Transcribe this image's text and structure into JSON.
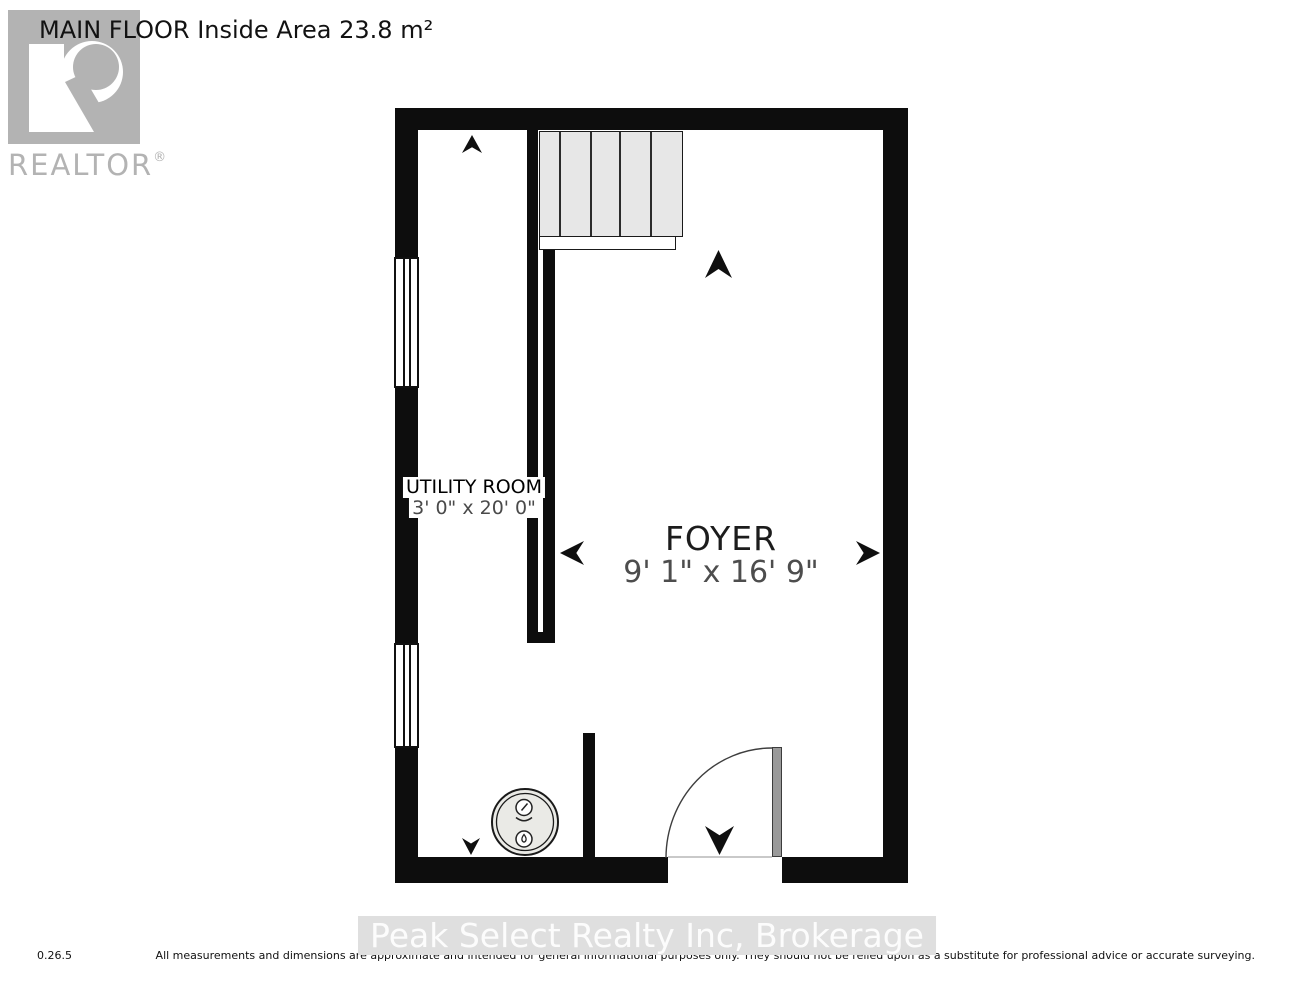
{
  "header": {
    "title": "MAIN FLOOR Inside Area 23.8 m²"
  },
  "logo": {
    "brand": "REALTOR",
    "registered": "®"
  },
  "floorplan": {
    "rooms": [
      {
        "name": "UTILITY ROOM",
        "dimensions": "3' 0\" x 20' 0\""
      },
      {
        "name": "FOYER",
        "dimensions": "9' 1\" x 16' 9\""
      }
    ],
    "symbols": [
      "stairs",
      "stair-landing",
      "entry-door-swing",
      "water-heater",
      "window",
      "north-arrow"
    ],
    "colors": {
      "wall": "#0d0d0d",
      "stairs_fill": "#e7e7e7",
      "appliance_fill": "#eaeae6",
      "door_leaf": "#9a9a9a",
      "logo_gray": "#b3b3b3",
      "dimension_text": "#4d4d4d",
      "watermark_bg": "#dfdfdf",
      "watermark_text": "#fcfcfc"
    }
  },
  "footer": {
    "version": "0.26.5",
    "watermark": "Peak Select Realty Inc, Brokerage",
    "disclaimer": "All measurements and dimensions are approximate and intended for general informational purposes only. They should not be relied upon as a substitute for professional advice or accurate surveying."
  }
}
